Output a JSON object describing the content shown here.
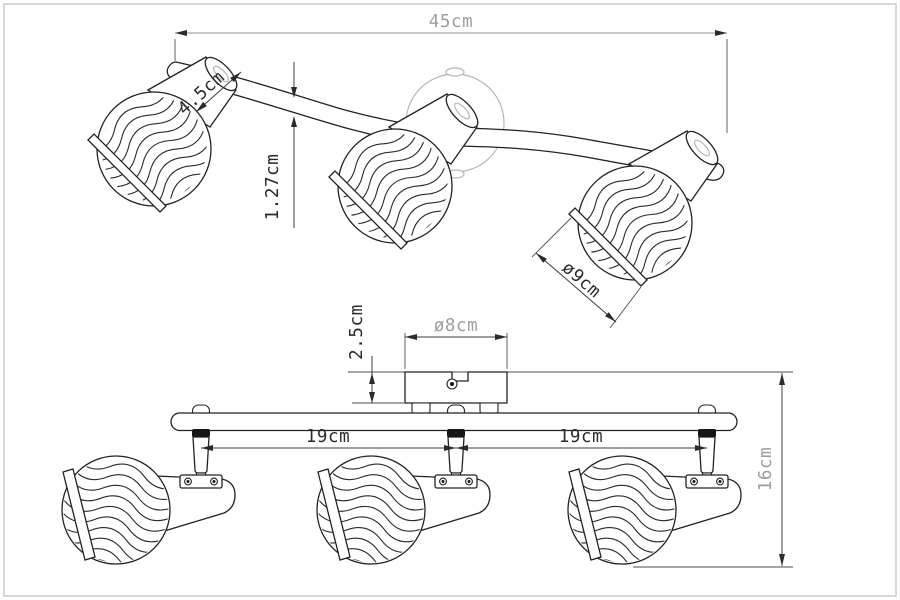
{
  "drawing": {
    "product": "three-spot ceiling light fixture dimension drawing",
    "views": {
      "top": "perspective view",
      "front": "front elevation view"
    },
    "dims": {
      "overall_width": "45cm",
      "holder_length": "4.5cm",
      "arm_thickness": "1.27cm",
      "shade_diameter": "ø9cm",
      "canopy_height": "2.5cm",
      "canopy_diameter": "ø8cm",
      "spacing_left": "19cm",
      "spacing_right": "19cm",
      "fixture_height": "16cm"
    },
    "colors": {
      "line": "#222222",
      "dimension_line": "#3c3c3c",
      "muted_text": "#9e9e9e",
      "canopy_gray": "#b6b6b6",
      "background": "#ffffff"
    }
  }
}
